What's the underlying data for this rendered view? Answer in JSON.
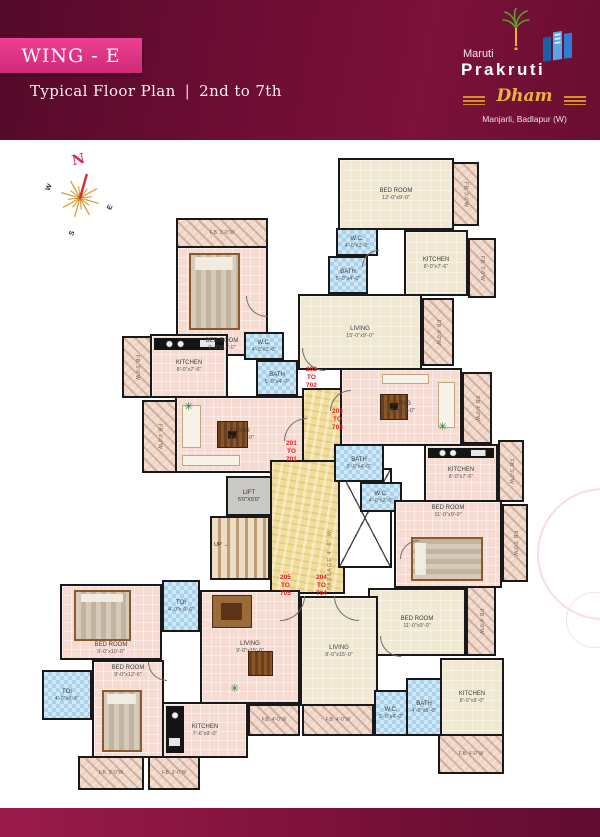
{
  "header": {
    "wing": "WING - E",
    "plan_type": "Typical Floor Plan",
    "separator": "|",
    "floors": "2nd to 7th",
    "brand": {
      "top": "Maruti",
      "name": "Prakruti",
      "script": "Dham",
      "location": "Manjarli, Badlapur (W)"
    }
  },
  "compass": {
    "n": "N",
    "e": "E",
    "s": "S",
    "w": "W"
  },
  "core": {
    "up": "UP",
    "up_arrow": "→",
    "passage": "PASSAGE 4'-6\" W"
  },
  "plan": {
    "plant_glyph": "✳",
    "rooms": [
      {
        "id": "fb-201-top",
        "label": "F.B. 3'-0\"W",
        "type": "balcony",
        "x": 176,
        "y": 218,
        "w": 92,
        "h": 30
      },
      {
        "id": "bedroom-201",
        "label": "BED ROOM",
        "dims": "9'-0\"x11'-0\"",
        "type": "pink",
        "x": 176,
        "y": 246,
        "w": 92,
        "h": 110,
        "furn": [
          "bed-v"
        ],
        "labelPos": "low"
      },
      {
        "id": "fb-201-left",
        "label": "F.B. 3'-0\"W",
        "type": "balcony",
        "x": 122,
        "y": 336,
        "w": 30,
        "h": 62,
        "rot": 90
      },
      {
        "id": "kitchen-201",
        "label": "KITCHEN",
        "dims": "8'-0\"x7'-6\"",
        "type": "pink",
        "x": 150,
        "y": 334,
        "w": 78,
        "h": 64,
        "furn": [
          "counter-top"
        ]
      },
      {
        "id": "wc-201",
        "label": "W.C.",
        "dims": "4'-0\"x2'-0\"",
        "type": "bath",
        "x": 244,
        "y": 332,
        "w": 40,
        "h": 28
      },
      {
        "id": "bath-201",
        "label": "BATH",
        "dims": "5'-0\"x4'-0\"",
        "type": "bath",
        "x": 256,
        "y": 360,
        "w": 42,
        "h": 36
      },
      {
        "id": "fb-201-living",
        "label": "F.B. 4'-0\"W",
        "type": "balcony",
        "x": 142,
        "y": 400,
        "w": 35,
        "h": 73,
        "rot": 90
      },
      {
        "id": "living-201",
        "label": "LIVING",
        "dims": "15'-0\"x9'-0\"",
        "type": "pink",
        "x": 175,
        "y": 396,
        "w": 130,
        "h": 77,
        "furn": [
          "sofa-left",
          "seat-bottom",
          "table-dark"
        ]
      },
      {
        "id": "lift",
        "label": "LIFT",
        "dims": "5'0\"X5'0\"",
        "type": "lift",
        "x": 226,
        "y": 476,
        "w": 46,
        "h": 40
      },
      {
        "id": "stairs",
        "type": "stairs",
        "x": 210,
        "y": 516,
        "w": 60,
        "h": 64
      },
      {
        "id": "passage-main",
        "type": "passage",
        "x": 270,
        "y": 460,
        "w": 75,
        "h": 134
      },
      {
        "id": "passage-upper",
        "type": "passage",
        "x": 302,
        "y": 388,
        "w": 43,
        "h": 74
      },
      {
        "id": "duct",
        "type": "duct",
        "x": 338,
        "y": 468,
        "w": 54,
        "h": 100
      },
      {
        "id": "bedroom-202",
        "label": "BED ROOM",
        "dims": "12'-0\"x9'-0\"",
        "type": "cream",
        "x": 338,
        "y": 158,
        "w": 116,
        "h": 72
      },
      {
        "id": "fb-202-bed",
        "label": "F.B. 3'-0\"W",
        "type": "balcony",
        "x": 452,
        "y": 162,
        "w": 27,
        "h": 64,
        "rot": 90
      },
      {
        "id": "wc-202",
        "label": "W.C.",
        "dims": "4'-0\"x2'-0\"",
        "type": "bath",
        "x": 336,
        "y": 228,
        "w": 42,
        "h": 28
      },
      {
        "id": "bath-202",
        "label": "BATH",
        "dims": "5'-0\"x4'-0\"",
        "type": "bath",
        "x": 328,
        "y": 256,
        "w": 40,
        "h": 38
      },
      {
        "id": "kitchen-202",
        "label": "KITCHEN",
        "dims": "8'-0\"x7'-6\"",
        "type": "cream",
        "x": 404,
        "y": 230,
        "w": 64,
        "h": 66
      },
      {
        "id": "fb-202-kitchen",
        "label": "F.B. 3'-0\"W",
        "type": "balcony",
        "x": 468,
        "y": 238,
        "w": 28,
        "h": 60,
        "rot": 90
      },
      {
        "id": "living-202",
        "label": "LIVING",
        "dims": "15'-0\"x9'-0\"",
        "type": "cream",
        "x": 298,
        "y": 294,
        "w": 124,
        "h": 76
      },
      {
        "id": "fb-202-living",
        "label": "F.B. 4'-0\"W",
        "type": "balcony",
        "x": 422,
        "y": 298,
        "w": 32,
        "h": 68,
        "rot": 90
      },
      {
        "id": "living-203",
        "label": "LIVING",
        "dims": "15'-0\"x9'-0\"",
        "type": "pink",
        "x": 340,
        "y": 368,
        "w": 122,
        "h": 78,
        "furn": [
          "seat-top",
          "sofa-right",
          "table-dark"
        ]
      },
      {
        "id": "fb-203-living",
        "label": "F.B. 4'-0\"W",
        "type": "balcony",
        "x": 462,
        "y": 372,
        "w": 30,
        "h": 72,
        "rot": 90
      },
      {
        "id": "bath-203",
        "label": "BATH",
        "dims": "5'-0\"x4'-0\"",
        "type": "bath",
        "x": 334,
        "y": 444,
        "w": 50,
        "h": 38
      },
      {
        "id": "wc-203",
        "label": "W.C.",
        "dims": "4'-0\"x2'-0\"",
        "type": "bath",
        "x": 360,
        "y": 482,
        "w": 42,
        "h": 30
      },
      {
        "id": "kitchen-203",
        "label": "KITCHEN",
        "dims": "8'-0\"x7'-6\"",
        "type": "pink",
        "x": 424,
        "y": 444,
        "w": 74,
        "h": 58,
        "furn": [
          "counter-top"
        ]
      },
      {
        "id": "fb-203-kitchen",
        "label": "F.B. 3'-0\"W",
        "type": "balcony",
        "x": 498,
        "y": 440,
        "w": 26,
        "h": 62,
        "rot": 90
      },
      {
        "id": "bedroom-203",
        "label": "BED ROOM",
        "dims": "11'-0\"x9'-0\"",
        "type": "pink",
        "x": 394,
        "y": 500,
        "w": 108,
        "h": 88,
        "furn": [
          "bed-h"
        ],
        "labelPos": "high"
      },
      {
        "id": "fb-203-bed",
        "label": "F.B. 3'-0\"W",
        "type": "balcony",
        "x": 502,
        "y": 504,
        "w": 26,
        "h": 78,
        "rot": 90
      },
      {
        "id": "bedroom-204",
        "label": "BED ROOM",
        "dims": "11'-0\"x9'-0\"",
        "type": "cream",
        "x": 368,
        "y": 588,
        "w": 98,
        "h": 68
      },
      {
        "id": "fb-204-bed",
        "label": "F.B. 4'-0\"W",
        "type": "balcony",
        "x": 466,
        "y": 586,
        "w": 30,
        "h": 70,
        "rot": 90
      },
      {
        "id": "living-204",
        "label": "LIVING",
        "dims": "9'-0\"x15'-0\"",
        "type": "cream",
        "x": 300,
        "y": 596,
        "w": 78,
        "h": 110
      },
      {
        "id": "wc-204",
        "label": "W.C.",
        "dims": "3'-0\"x4'-0\"",
        "type": "bath",
        "x": 374,
        "y": 690,
        "w": 34,
        "h": 46
      },
      {
        "id": "bath-204",
        "label": "BATH",
        "dims": "4'-0\"x5'-0\"",
        "type": "bath",
        "x": 406,
        "y": 678,
        "w": 36,
        "h": 58
      },
      {
        "id": "kitchen-204",
        "label": "KITCHEN",
        "dims": "8'-0\"x9'-0\"",
        "type": "cream",
        "x": 440,
        "y": 658,
        "w": 64,
        "h": 78
      },
      {
        "id": "fb-204-kitchen",
        "label": "F.B. 4'-0\"W",
        "type": "balcony",
        "x": 438,
        "y": 734,
        "w": 66,
        "h": 40
      },
      {
        "id": "fb-204-living",
        "label": "F.B. 4'-0\"W",
        "type": "balcony",
        "x": 302,
        "y": 704,
        "w": 72,
        "h": 32
      },
      {
        "id": "toi-205a",
        "label": "TOI",
        "dims": "4'-0\"x 6'-6\"",
        "type": "bath",
        "x": 162,
        "y": 580,
        "w": 38,
        "h": 52
      },
      {
        "id": "bedroom-205a",
        "label": "BED ROOM",
        "dims": "9'-0\"x10'-0\"",
        "type": "pink",
        "x": 60,
        "y": 584,
        "w": 102,
        "h": 76,
        "furn": [
          "bed-v"
        ],
        "labelPos": "low"
      },
      {
        "id": "living-205",
        "label": "LIVING",
        "dims": "9'-0\"x15'-0\"",
        "type": "pink",
        "x": 200,
        "y": 590,
        "w": 100,
        "h": 114,
        "furn": [
          "dining-set",
          "table-dark-sm"
        ]
      },
      {
        "id": "toi-205b",
        "label": "TOI",
        "dims": "4'-0\"x6'-6\"",
        "type": "bath",
        "x": 42,
        "y": 670,
        "w": 50,
        "h": 50
      },
      {
        "id": "bedroom-205b",
        "label": "BED ROOM",
        "dims": "9'-0\"x12'-6\"",
        "type": "pink",
        "x": 92,
        "y": 660,
        "w": 72,
        "h": 98,
        "furn": [
          "bed-v-low"
        ],
        "labelPos": "high"
      },
      {
        "id": "kitchen-205",
        "label": "KITCHEN",
        "dims": "7'-6\"x9'-0\"",
        "type": "pink",
        "x": 162,
        "y": 702,
        "w": 86,
        "h": 56,
        "furn": [
          "counter-left"
        ]
      },
      {
        "id": "fb-205-a",
        "label": "F.B. 3'-0\"W",
        "type": "balcony",
        "x": 78,
        "y": 756,
        "w": 66,
        "h": 34
      },
      {
        "id": "fb-205-b",
        "label": "F.B. 3'-0\"W",
        "type": "balcony",
        "x": 148,
        "y": 756,
        "w": 52,
        "h": 34
      },
      {
        "id": "fb-205-living",
        "label": "F.B. 4'-0\"W",
        "type": "balcony",
        "x": 248,
        "y": 704,
        "w": 52,
        "h": 32
      }
    ],
    "unit_ranges": [
      {
        "id": "unit-201-701",
        "lines": [
          "201",
          "TO",
          "701"
        ],
        "x": 286,
        "y": 440
      },
      {
        "id": "unit-202-702",
        "lines": [
          "202",
          "TO",
          "702"
        ],
        "x": 306,
        "y": 366
      },
      {
        "id": "unit-203-703",
        "lines": [
          "203",
          "TO",
          "703"
        ],
        "x": 332,
        "y": 408
      },
      {
        "id": "unit-205-705",
        "lines": [
          "205",
          "TO",
          "705"
        ],
        "x": 280,
        "y": 574
      },
      {
        "id": "unit-204-704",
        "lines": [
          "204",
          "TO",
          "704"
        ],
        "x": 316,
        "y": 574
      }
    ],
    "doors": [
      {
        "x": 246,
        "y": 296,
        "r": 20,
        "rot": 0
      },
      {
        "x": 284,
        "y": 418,
        "r": 22,
        "rot": 90
      },
      {
        "x": 302,
        "y": 348,
        "r": 22,
        "rot": 0
      },
      {
        "x": 330,
        "y": 390,
        "r": 20,
        "rot": 90
      },
      {
        "x": 280,
        "y": 596,
        "r": 24,
        "rot": 270
      },
      {
        "x": 334,
        "y": 596,
        "r": 24,
        "rot": 0
      },
      {
        "x": 380,
        "y": 636,
        "r": 20,
        "rot": 0
      },
      {
        "x": 400,
        "y": 540,
        "r": 18,
        "rot": 90
      },
      {
        "x": 148,
        "y": 662,
        "r": 18,
        "rot": 0
      },
      {
        "x": 362,
        "y": 250,
        "r": 16,
        "rot": 90
      }
    ],
    "plants": [
      {
        "x": 184,
        "y": 402
      },
      {
        "x": 438,
        "y": 422
      },
      {
        "x": 230,
        "y": 684
      }
    ]
  },
  "colors": {
    "maroon_dark": "#540a29",
    "maroon_light": "#8c1a42",
    "banner_pink": "#e33083",
    "wall": "#191919",
    "room_pink": "#f6dbd2",
    "room_cream": "#f0e8d1",
    "bath_blue": "#cfe7f6",
    "balcony": "#eed7c9",
    "passage_yellow": "#f2dd9b",
    "lift_gray": "#cbc9c5",
    "unit_red": "#e02020",
    "gold": "#e9b245"
  }
}
